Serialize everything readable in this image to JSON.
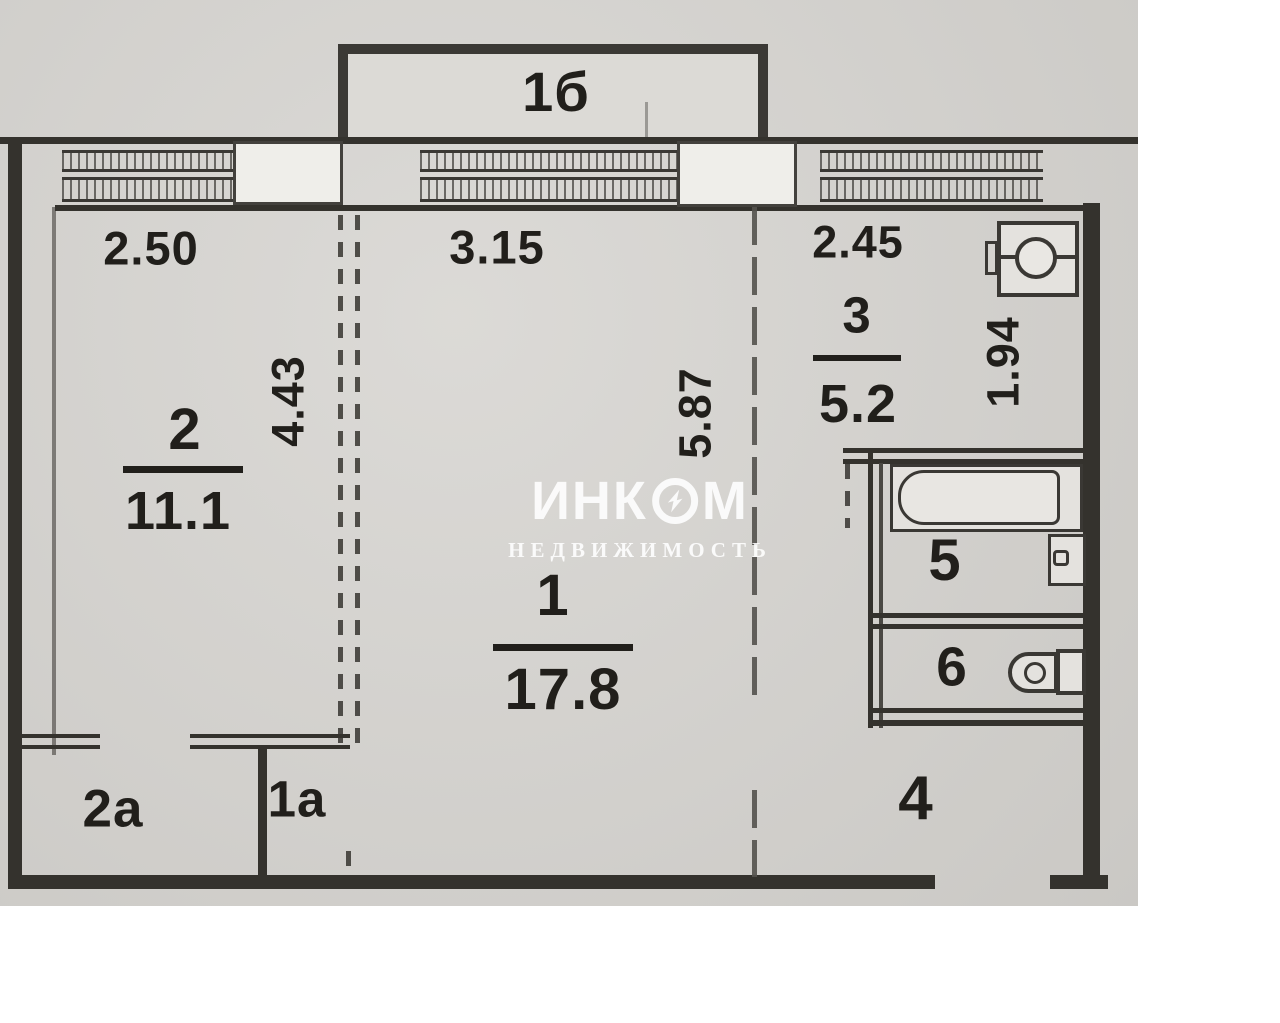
{
  "document_type": "apartment-floor-plan-scan",
  "watermark": {
    "brand": "ИНКОМ",
    "subtitle": "НЕДВИЖИМОСТЬ",
    "logo_icon": "lightning-bolt-in-circle-icon"
  },
  "rooms": {
    "balcony": {
      "label": "1б"
    },
    "bedroom": {
      "label": "2",
      "area": "11.1",
      "dim_width": "2.50",
      "dim_height": "4.43"
    },
    "living": {
      "label": "1",
      "area": "17.8",
      "dim_width": "3.15",
      "dim_height": "5.87"
    },
    "kitchen": {
      "label": "3",
      "area": "5.2",
      "dim_width": "2.45",
      "dim_height": "1.94"
    },
    "bath": {
      "label": "5"
    },
    "wc": {
      "label": "6"
    },
    "hall": {
      "label": "4"
    },
    "closet_2a": {
      "label": "2а"
    },
    "closet_1a": {
      "label": "1а"
    }
  },
  "fixtures": {
    "kitchen_sink": "sink-stove-icon",
    "bathtub": "bathtub-icon",
    "washbasin": "washbasin-icon",
    "toilet": "toilet-icon"
  },
  "colors": {
    "paper": "#d5d3cf",
    "wall_line": "#34322d",
    "label_text": "#211f1b",
    "pier_fill": "#efeeea",
    "watermark": "#ffffff"
  }
}
